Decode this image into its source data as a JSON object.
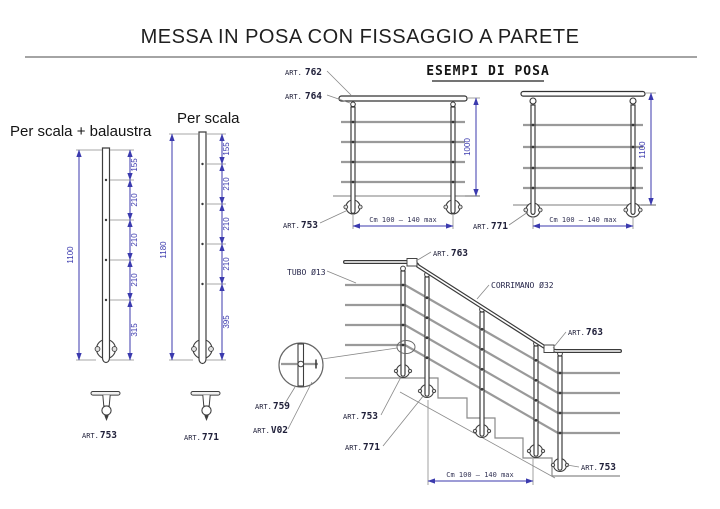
{
  "title": "MESSA IN POSA CON FISSAGGIO A PARETE",
  "section_header": "ESEMPI DI POSA",
  "posts": {
    "a": {
      "name": "Per scala + balaustra",
      "total": "1100",
      "segs": [
        "155",
        "210",
        "210",
        "210",
        "315"
      ],
      "art": {
        "p": "ART.",
        "n": "753"
      }
    },
    "b": {
      "name": "Per scala",
      "total": "1180",
      "segs": [
        "155",
        "210",
        "210",
        "210",
        "395"
      ],
      "art": {
        "p": "ART.",
        "n": "771"
      }
    }
  },
  "ex1": {
    "art_handrail": {
      "p": "ART.",
      "n": "762"
    },
    "art_bracket": {
      "p": "ART.",
      "n": "764"
    },
    "art_flange": {
      "p": "ART.",
      "n": "753"
    },
    "height": "1000",
    "width": "Cm 100 – 140 max"
  },
  "ex2": {
    "art_flange": {
      "p": "ART.",
      "n": "771"
    },
    "height": "1100",
    "width": "Cm 100 – 140 max"
  },
  "stair": {
    "tube_label": "TUBO Ø13",
    "handrail_label": "CORRIMANO Ø32",
    "art_corner_top": {
      "p": "ART.",
      "n": "763"
    },
    "art_corner_mid": {
      "p": "ART.",
      "n": "763"
    },
    "art_detail_1": {
      "p": "ART.",
      "n": "759"
    },
    "art_detail_2": {
      "p": "ART.",
      "n": "V02"
    },
    "art_post_top": {
      "p": "ART.",
      "n": "753"
    },
    "art_post_slope": {
      "p": "ART.",
      "n": "771"
    },
    "art_post_bottom": {
      "p": "ART.",
      "n": "753"
    },
    "width": "Cm 100 – 140 max"
  },
  "colors": {
    "dimension_blue": "#3b3aae",
    "label_navy": "#20203a",
    "tube_gray": "#9a9a9a",
    "outline_dark": "#3e3e3e",
    "background": "#ffffff"
  }
}
